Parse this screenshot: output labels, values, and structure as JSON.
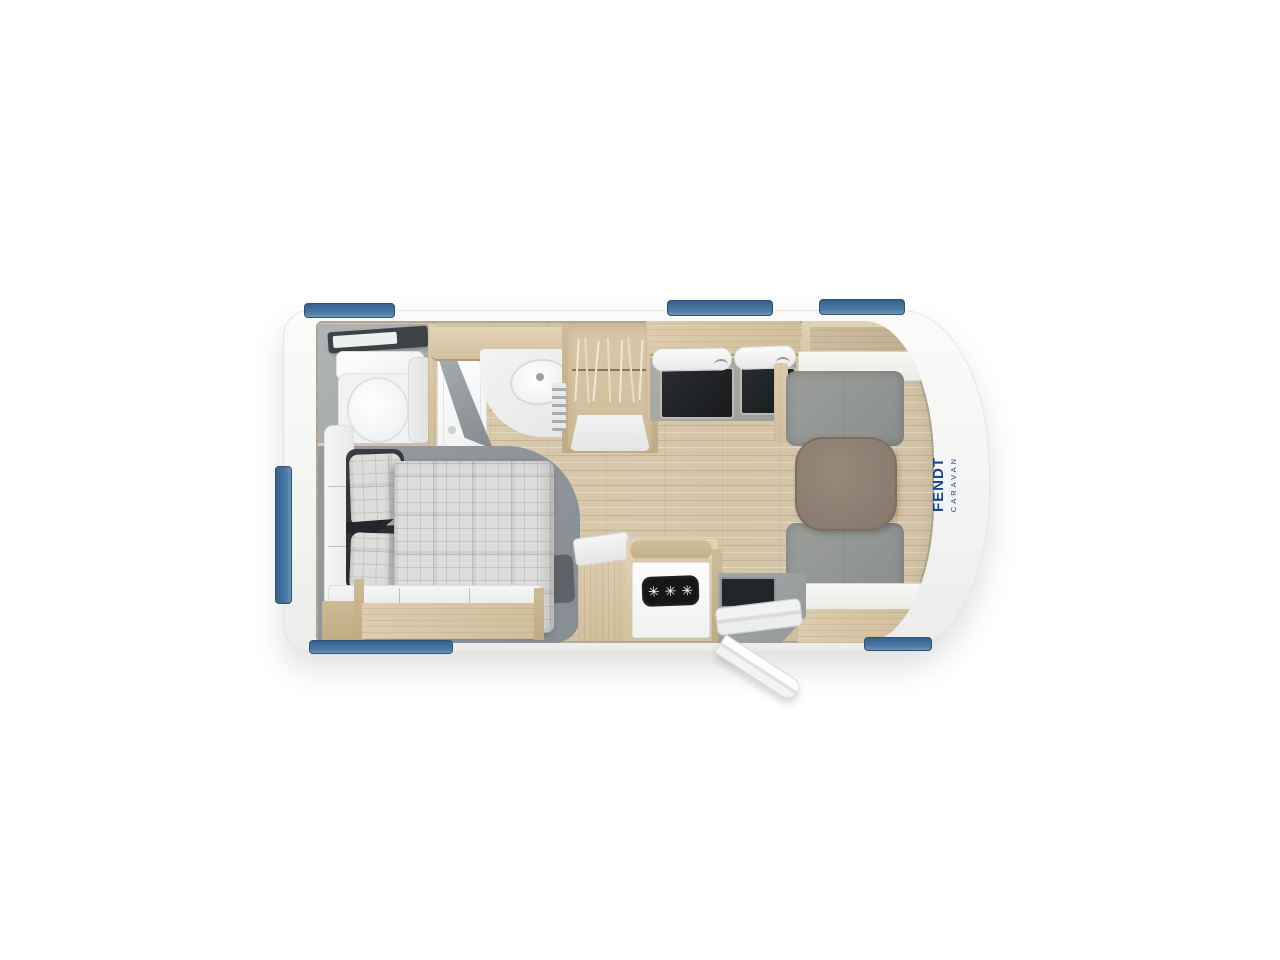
{
  "brand": {
    "fendt": "FENDT",
    "caravan": "CARAVAN"
  },
  "kitchen": {
    "hob_burner_symbol": "✳",
    "burner_count": 3
  },
  "colors": {
    "background": "#ffffff",
    "body_white": "#f7f7f5",
    "window_blue": "#4d7ba6",
    "window_blue_dark": "#35618c",
    "wood_cabinet": "#d9c9a9",
    "wood_floor": "#d7c7a9",
    "bathroom_floor_gray": "#a9adae",
    "bed_platform_gray": "#8e9499",
    "cushion_gray": "#939692",
    "table_taupe": "#8d8070",
    "blanket_plaid": "#dcdcda",
    "pillow_dark": "#33363a",
    "hob_black": "#17191b",
    "logo_blue": "#17498f",
    "hitch_red": "#d5423a"
  }
}
